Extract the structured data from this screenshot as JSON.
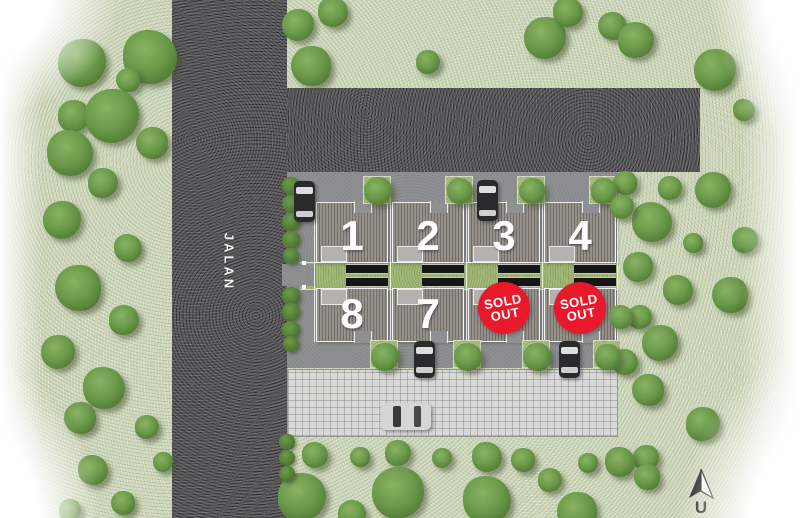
{
  "site": {
    "road_label": "JALAN",
    "north_label": "U",
    "sold_badge": {
      "line1": "SOLD",
      "line2": "OUT",
      "color": "#e8192b"
    },
    "colors": {
      "grass": "#cdd6ba",
      "road": "#57575a",
      "pavement": "#8e9092",
      "corridor_green": "#a3b876",
      "roof": "#8d8983",
      "roof_stripe": "#6e6a64",
      "driveway": "#161616",
      "paver": "#d9d9d7",
      "tree": "#6b9a4a",
      "number_text": "#ffffff",
      "sold_badge_red": "#e8192b"
    },
    "units": [
      {
        "number": "1",
        "row": 0,
        "col": 0,
        "status": "available"
      },
      {
        "number": "2",
        "row": 0,
        "col": 1,
        "status": "available"
      },
      {
        "number": "3",
        "row": 0,
        "col": 2,
        "status": "available"
      },
      {
        "number": "4",
        "row": 0,
        "col": 3,
        "status": "available"
      },
      {
        "number": "8",
        "row": 1,
        "col": 0,
        "status": "available"
      },
      {
        "number": "7",
        "row": 1,
        "col": 1,
        "status": "available"
      },
      {
        "number": "",
        "row": 1,
        "col": 2,
        "status": "sold_out"
      },
      {
        "number": "",
        "row": 1,
        "col": 3,
        "status": "sold_out"
      }
    ],
    "trees": [
      [
        82,
        63,
        24
      ],
      [
        150,
        57,
        27
      ],
      [
        128,
        80,
        12
      ],
      [
        74,
        116,
        16
      ],
      [
        112,
        116,
        27
      ],
      [
        70,
        153,
        23
      ],
      [
        152,
        143,
        16
      ],
      [
        103,
        183,
        15
      ],
      [
        62,
        220,
        19
      ],
      [
        128,
        248,
        14
      ],
      [
        78,
        288,
        23
      ],
      [
        124,
        320,
        15
      ],
      [
        58,
        352,
        17
      ],
      [
        104,
        388,
        21
      ],
      [
        80,
        418,
        16
      ],
      [
        147,
        427,
        12
      ],
      [
        163,
        462,
        10
      ],
      [
        93,
        470,
        15
      ],
      [
        123,
        503,
        12
      ],
      [
        70,
        510,
        11
      ],
      [
        298,
        25,
        16
      ],
      [
        333,
        12,
        15
      ],
      [
        311,
        66,
        20
      ],
      [
        428,
        62,
        12
      ],
      [
        545,
        38,
        21
      ],
      [
        568,
        12,
        15
      ],
      [
        612,
        26,
        14
      ],
      [
        636,
        40,
        18
      ],
      [
        715,
        70,
        21
      ],
      [
        744,
        110,
        11
      ],
      [
        625,
        183,
        12
      ],
      [
        670,
        188,
        12
      ],
      [
        713,
        190,
        18
      ],
      [
        652,
        222,
        20
      ],
      [
        693,
        243,
        10
      ],
      [
        745,
        240,
        13
      ],
      [
        638,
        267,
        15
      ],
      [
        678,
        290,
        15
      ],
      [
        730,
        295,
        18
      ],
      [
        640,
        317,
        12
      ],
      [
        660,
        343,
        18
      ],
      [
        625,
        362,
        13
      ],
      [
        648,
        390,
        16
      ],
      [
        703,
        424,
        17
      ],
      [
        646,
        458,
        13
      ],
      [
        315,
        455,
        13
      ],
      [
        360,
        457,
        10
      ],
      [
        398,
        453,
        13
      ],
      [
        442,
        458,
        10
      ],
      [
        487,
        457,
        15
      ],
      [
        523,
        460,
        12
      ],
      [
        550,
        480,
        12
      ],
      [
        588,
        463,
        10
      ],
      [
        620,
        462,
        15
      ],
      [
        647,
        477,
        13
      ],
      [
        302,
        497,
        24
      ],
      [
        398,
        493,
        26
      ],
      [
        487,
        500,
        24
      ],
      [
        577,
        512,
        20
      ],
      [
        352,
        514,
        14
      ],
      [
        378,
        191,
        14
      ],
      [
        460,
        191,
        13
      ],
      [
        532,
        191,
        13
      ],
      [
        604,
        191,
        13
      ],
      [
        385,
        357,
        14
      ],
      [
        468,
        357,
        14
      ],
      [
        537,
        357,
        14
      ],
      [
        608,
        357,
        13
      ],
      [
        622,
        207,
        12
      ],
      [
        621,
        317,
        12
      ]
    ],
    "hedge_trees": [
      [
        291,
        186,
        9
      ],
      [
        291,
        204,
        9
      ],
      [
        291,
        222,
        9
      ],
      [
        291,
        240,
        9
      ],
      [
        291,
        256,
        8
      ],
      [
        291,
        296,
        9
      ],
      [
        291,
        312,
        9
      ],
      [
        291,
        330,
        9
      ],
      [
        291,
        344,
        8
      ],
      [
        287,
        442,
        8
      ],
      [
        287,
        458,
        8
      ],
      [
        287,
        474,
        8
      ]
    ],
    "planters": [
      [
        363,
        176,
        28,
        28
      ],
      [
        445,
        176,
        28,
        28
      ],
      [
        517,
        176,
        28,
        28
      ],
      [
        589,
        176,
        28,
        28
      ],
      [
        370,
        340,
        28,
        28
      ],
      [
        453,
        340,
        28,
        28
      ],
      [
        522,
        340,
        28,
        28
      ],
      [
        593,
        340,
        28,
        28
      ]
    ],
    "cars": [
      {
        "x": 294,
        "y": 181,
        "w": 21,
        "h": 41,
        "dir": "v",
        "body": "dark"
      },
      {
        "x": 477,
        "y": 180,
        "w": 21,
        "h": 41,
        "dir": "v",
        "body": "dark"
      },
      {
        "x": 414,
        "y": 341,
        "w": 21,
        "h": 37,
        "dir": "v",
        "body": "dark"
      },
      {
        "x": 559,
        "y": 341,
        "w": 21,
        "h": 37,
        "dir": "v",
        "body": "dark"
      },
      {
        "x": 381,
        "y": 403,
        "w": 50,
        "h": 27,
        "dir": "h",
        "body": "silver"
      }
    ]
  }
}
